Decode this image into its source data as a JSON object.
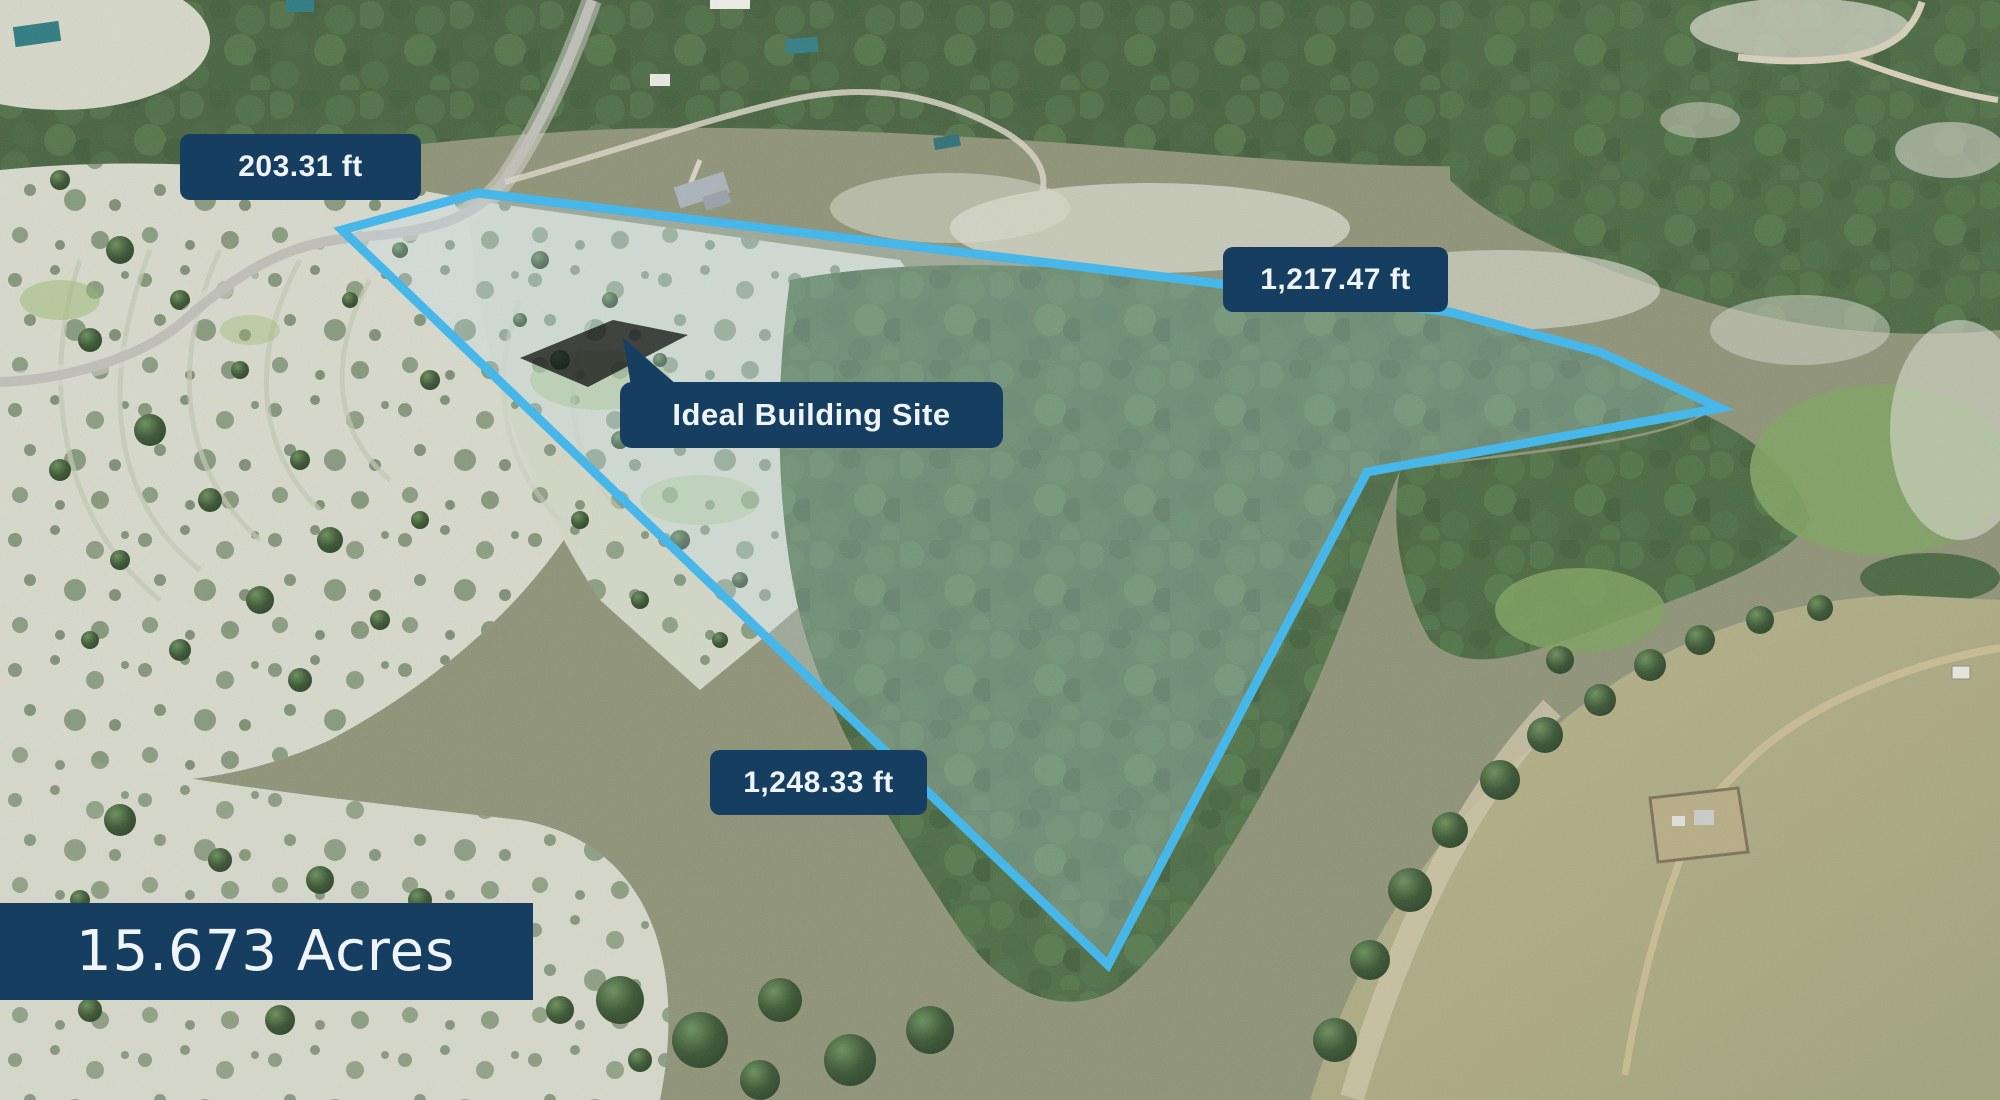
{
  "page": {
    "type": "real-estate-aerial-boundary-map",
    "description": "Drone aerial photo of wooded hill-country acreage with surveyed property boundary overlay"
  },
  "property": {
    "acreage": "15.673 Acres",
    "boundary_color": "#47b6e8",
    "boundary_fill": "rgba(198,226,240,0.27)",
    "label_background": "#163e61",
    "label_text_color": "#eef4f8",
    "boundary_points": [
      [
        342,
        230
      ],
      [
        478,
        193
      ],
      [
        1450,
        312
      ],
      [
        1600,
        352
      ],
      [
        1720,
        408
      ],
      [
        1367,
        472
      ],
      [
        1108,
        965
      ]
    ],
    "building_pad_points": [
      [
        520,
        358
      ],
      [
        613,
        320
      ],
      [
        688,
        335
      ],
      [
        588,
        387
      ]
    ],
    "callout_pointer_points": [
      [
        623,
        338
      ],
      [
        633,
        398
      ],
      [
        692,
        398
      ]
    ]
  },
  "measurements": {
    "north_edge": "203.31 ft",
    "east_edge": "1,217.47 ft",
    "west_edge": "1,248.33 ft"
  },
  "callout": {
    "building_site": "Ideal Building Site"
  }
}
